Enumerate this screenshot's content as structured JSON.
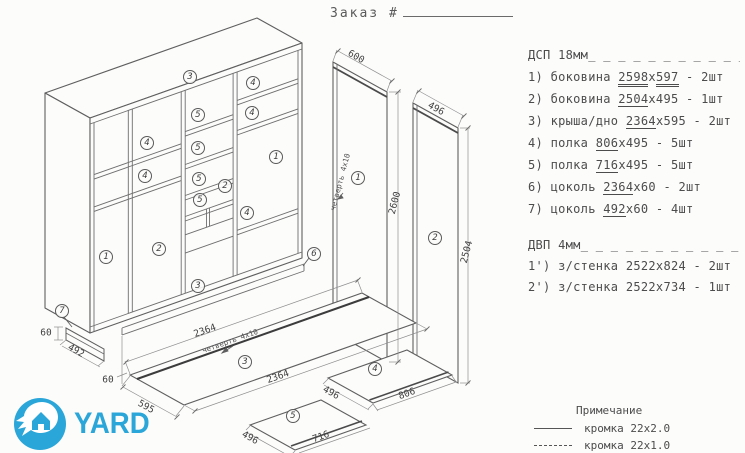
{
  "order": {
    "label": "Заказ #"
  },
  "logo": {
    "text": "YARD",
    "brand_blue": "#2ba6d9",
    "icon": "hand-house-icon"
  },
  "parts": {
    "header_dsp": "ДСП 18мм",
    "header_dvp": "ДВП 4мм",
    "rule": "_ _ _ _ _ _ _ _ _ _ _",
    "items": [
      {
        "pre": "1) боковина ",
        "d1": "2598",
        "mid": "x",
        "d2": "597",
        "post": " - 2шт"
      },
      {
        "pre": "2) боковина ",
        "d1": "2504",
        "mid": "x495 - 1шт",
        "d2": "",
        "post": ""
      },
      {
        "pre": "3) крыша/дно ",
        "d1": "2364",
        "mid": "x595 - 2шт",
        "d2": "",
        "post": ""
      },
      {
        "pre": "4) полка ",
        "d1": "806",
        "mid": "x495 - 5шт",
        "d2": "",
        "post": ""
      },
      {
        "pre": "5) полка ",
        "d1": "716",
        "mid": "x495 - 5шт",
        "d2": "",
        "post": ""
      },
      {
        "pre": "6) цоколь ",
        "d1": "2364",
        "mid": "x60 - 2шт",
        "d2": "",
        "post": ""
      },
      {
        "pre": "7) цоколь ",
        "d1": "492",
        "mid": "x60 - 4шт",
        "d2": "",
        "post": ""
      }
    ],
    "dvp_items": [
      {
        "text": "1') з/стенка 2522x824 - 2шт"
      },
      {
        "text": "2') з/стенка 2522x734 - 1шт"
      }
    ]
  },
  "notes": {
    "title": "Примечание",
    "line1": "кромка 22x2.0",
    "line2": "кромка 22x1.0"
  },
  "callouts": [
    {
      "n": "3"
    },
    {
      "n": "4"
    },
    {
      "n": "4"
    },
    {
      "n": "5"
    },
    {
      "n": "4"
    },
    {
      "n": "5"
    },
    {
      "n": "1"
    },
    {
      "n": "4"
    },
    {
      "n": "5"
    },
    {
      "n": "2"
    },
    {
      "n": "5"
    },
    {
      "n": "4"
    },
    {
      "n": "1"
    },
    {
      "n": "2"
    },
    {
      "n": "3"
    },
    {
      "n": "6"
    },
    {
      "n": "7"
    },
    {
      "n": "3"
    },
    {
      "n": "4"
    },
    {
      "n": "5"
    },
    {
      "n": "1"
    },
    {
      "n": "2"
    }
  ],
  "dims": [
    {
      "t": "600"
    },
    {
      "t": "2600"
    },
    {
      "t": "496"
    },
    {
      "t": "2504"
    },
    {
      "t": "четверть 4x10"
    },
    {
      "t": "2364"
    },
    {
      "t": "четверть 4x10"
    },
    {
      "t": "2364"
    },
    {
      "t": "595"
    },
    {
      "t": "496"
    },
    {
      "t": "806"
    },
    {
      "t": "496"
    },
    {
      "t": "716"
    },
    {
      "t": "60"
    },
    {
      "t": "492"
    },
    {
      "t": "60"
    }
  ]
}
